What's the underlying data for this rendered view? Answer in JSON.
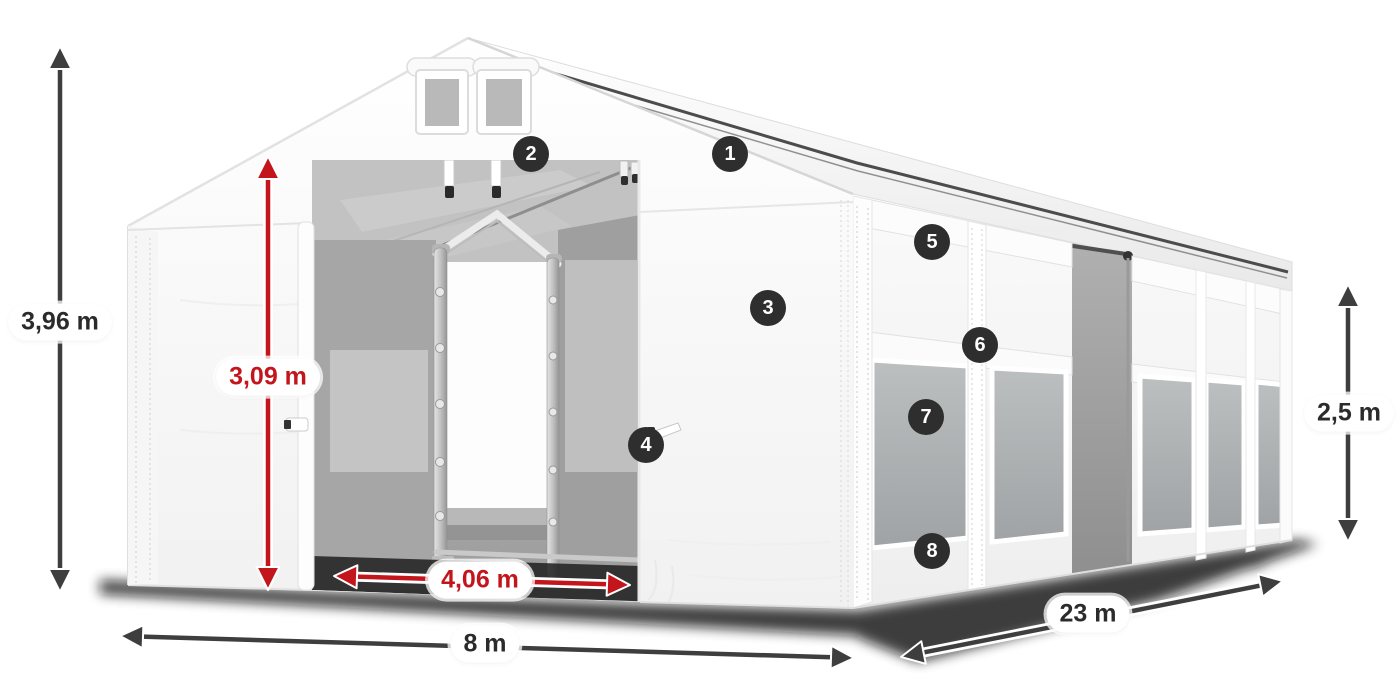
{
  "dimensions": {
    "total_height": "3,96 m",
    "entrance_height": "3,09 m",
    "entrance_width": "4,06 m",
    "front_width": "8 m",
    "side_length": "23 m",
    "side_height": "2,5 m"
  },
  "callouts": [
    {
      "number": "1"
    },
    {
      "number": "2"
    },
    {
      "number": "3"
    },
    {
      "number": "4"
    },
    {
      "number": "5"
    },
    {
      "number": "6"
    },
    {
      "number": "7"
    },
    {
      "number": "8"
    }
  ],
  "colors": {
    "dimension_arrow_dark": "#3e3e3e",
    "dimension_arrow_red": "#c3161c",
    "badge_background": "#2e2e2e",
    "badge_text": "#ffffff",
    "label_background": "#ffffff"
  }
}
